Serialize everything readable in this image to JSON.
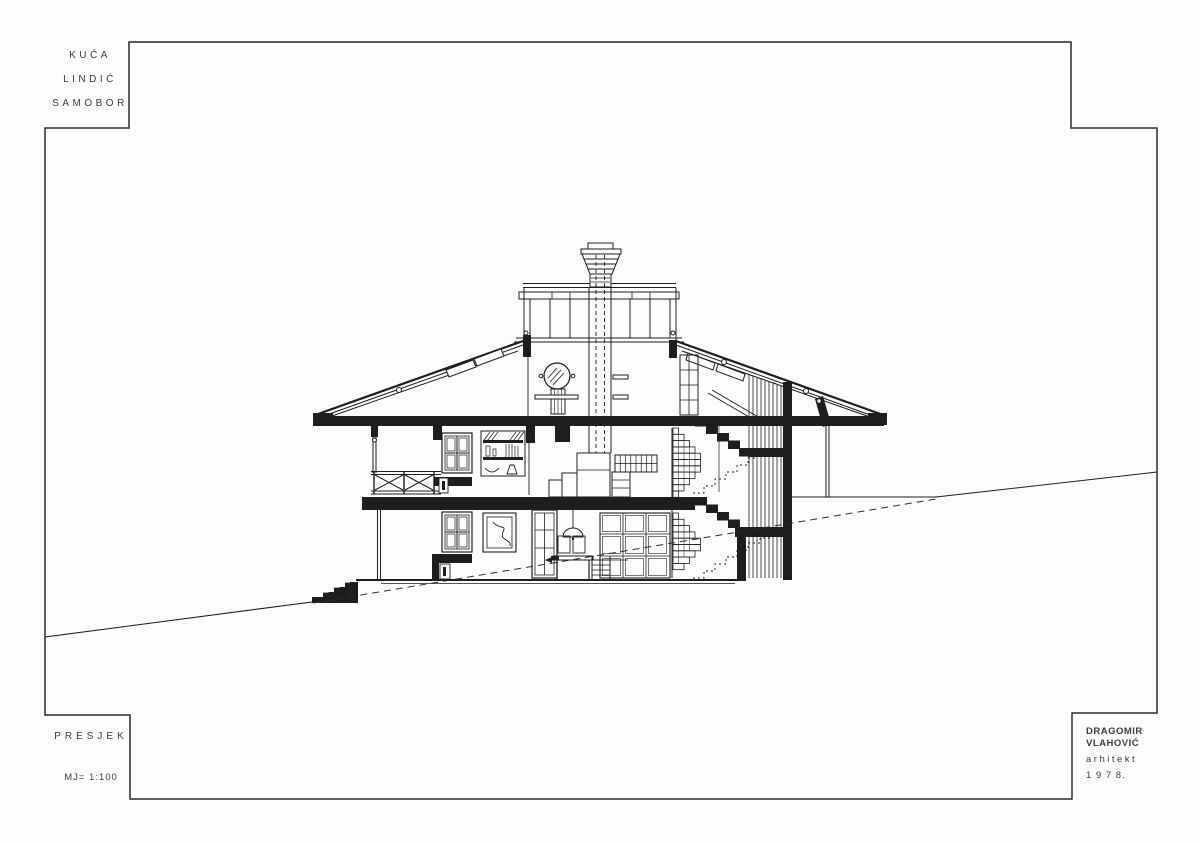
{
  "sheet": {
    "paper_color": "#fcfcfa",
    "ink_color": "#1e1e1e",
    "annotation_color": "#3d3d3d"
  },
  "title_blocks": {
    "project": {
      "line1": "KUĆA",
      "line2": "LINDIĆ",
      "line3": "SAMOBOR"
    },
    "drawing": {
      "title": "PRESJEK",
      "scale": "MJ= 1:100"
    },
    "architect": {
      "line1": "DRAGOMIR",
      "line2": "VLAHOVIĆ",
      "line3": "arhitekt",
      "line4": "1 9 7 8."
    }
  },
  "section_drawing": {
    "subject": "cross-section of a two-storey house with roof monitor on a sloping site",
    "features": [
      "corbelled brick chimney cap with dashed flue lines",
      "clerestory roof monitor with mullioned glazing",
      "pitched roof with skylights and bolted truss chords",
      "attic with round window, washstand and glazed door",
      "upper floor with balcony x-railing, window, bookshelf, loft boxes and drawers",
      "lower floor with window, picture, glazed door, pendant lamp, table, chairs and kitchen cabinets",
      "corbelled brick fireplace breasts on both floors",
      "right-hand staircase with black flights, landings and dotted climb lines",
      "vertical plank retaining wall",
      "exterior entry steps and dashed original-grade line"
    ]
  }
}
